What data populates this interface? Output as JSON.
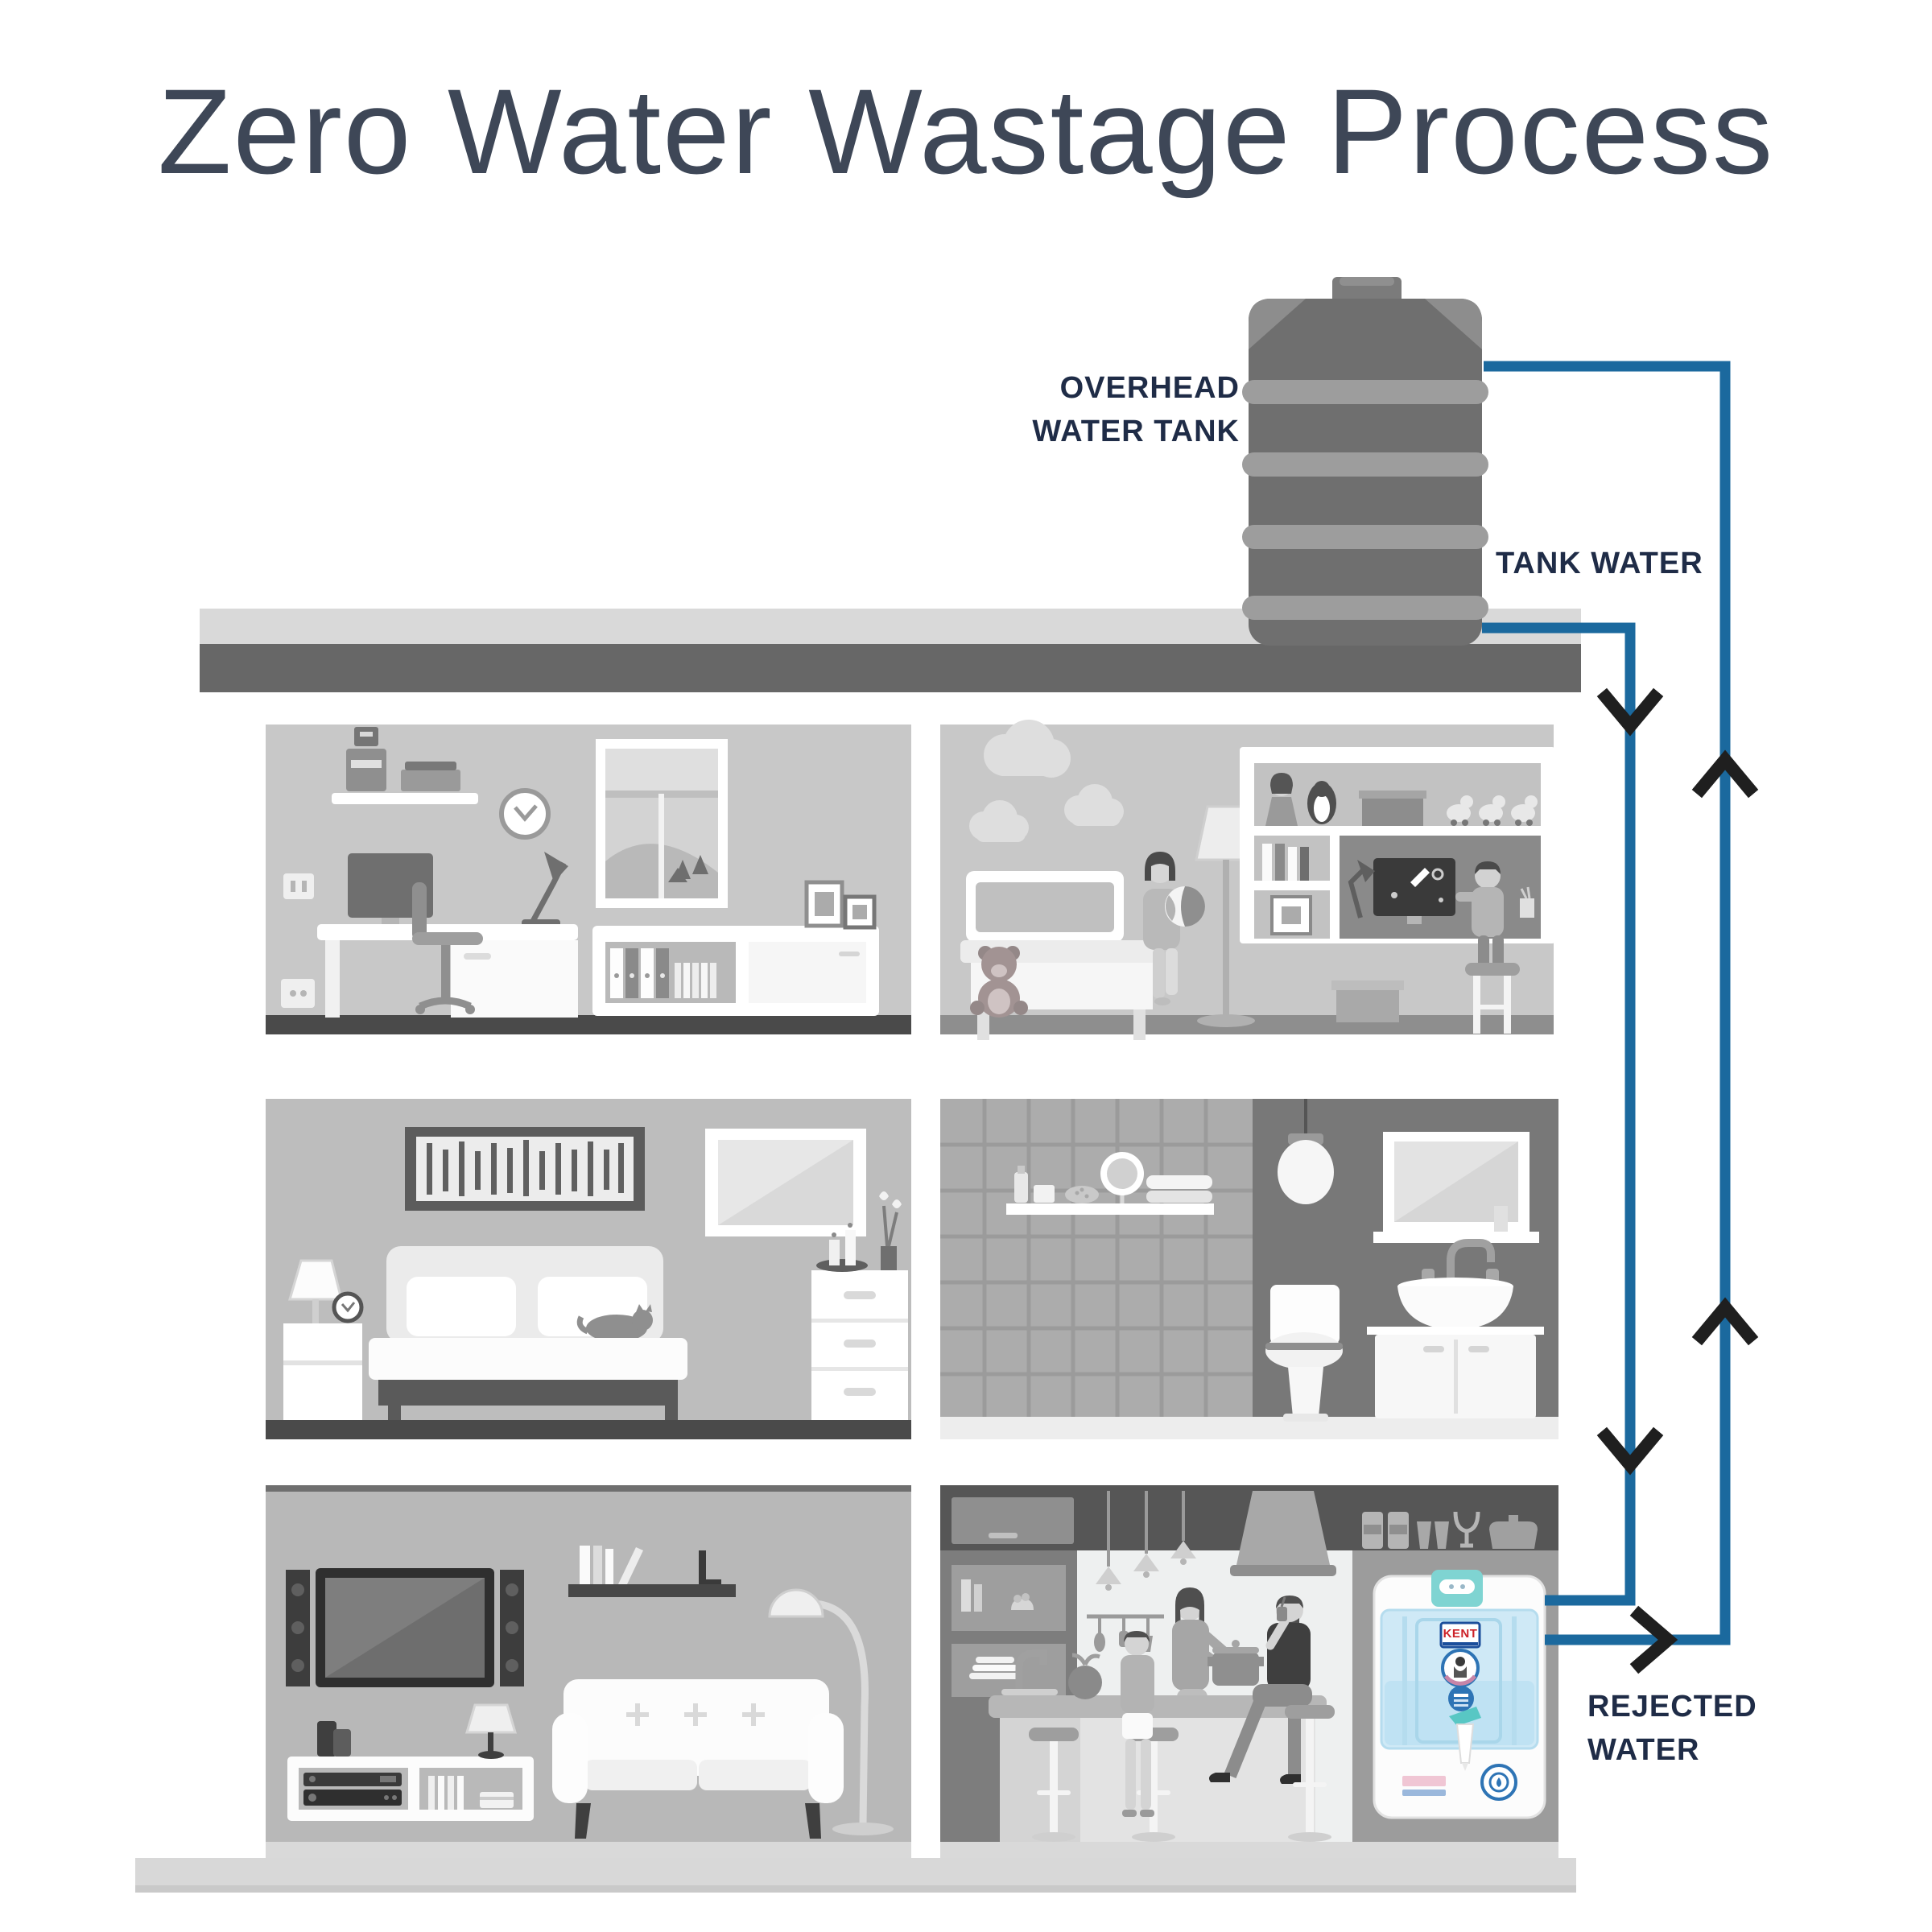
{
  "title": "Zero Water Wastage Process",
  "labels": {
    "overhead_line1": "OVERHEAD",
    "overhead_line2": "WATER TANK",
    "tank_water": "TANK WATER",
    "rejected_line1": "REJECTED",
    "rejected_line2": "WATER"
  },
  "purifier": {
    "brand": "KENT"
  },
  "colors": {
    "title": "#3e4757",
    "label": "#1f2c47",
    "pipe": "#1b699e",
    "arrow": "#1f1f1f",
    "tank_body": "#6f6f6f",
    "tank_rib": "#9d9d9d",
    "purifier_teal": "#7fd4d2",
    "purifier_tank_blue": "#cfe9f6",
    "badge_blue": "#2e74b5",
    "kent_red": "#cc2229"
  }
}
